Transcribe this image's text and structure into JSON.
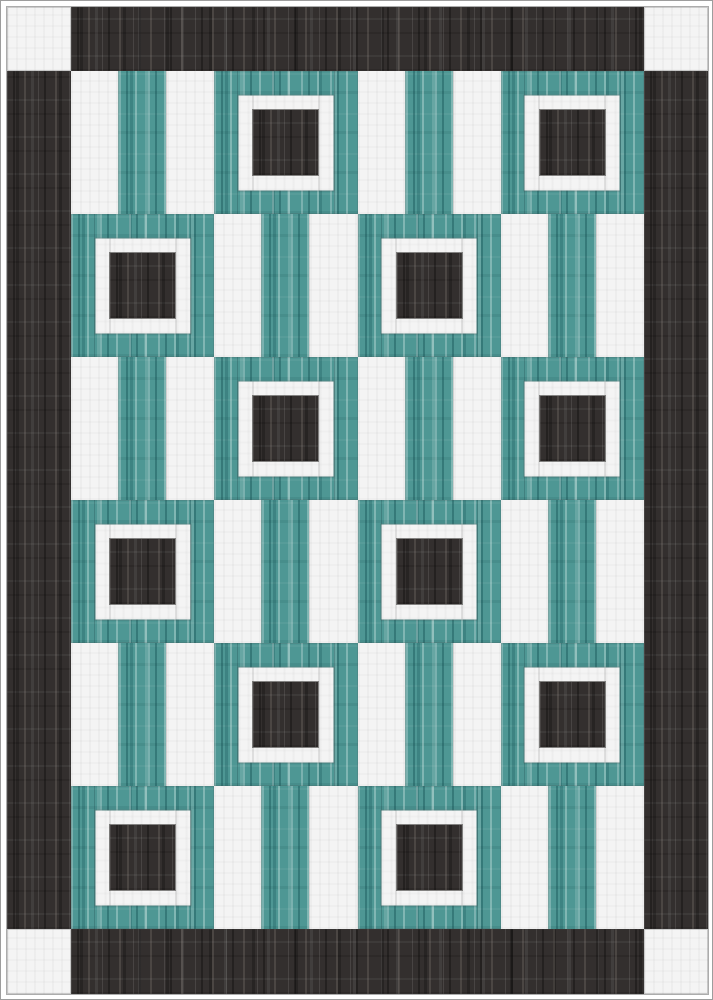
{
  "title": "Quilt pattern preview",
  "palette": {
    "page_background": "#ffffff",
    "page_edge_line": "#9d9d9d",
    "border_fabric_dark": "#332f2e",
    "fabric_teal": "#4e9794",
    "fabric_white": "#f4f4f4",
    "frame_center_dark": "#332f2e",
    "seam_line": "rgba(75,75,75,0.2)"
  },
  "quilt": {
    "border": {
      "fabric": "dark",
      "width_px": 64,
      "corner_squares": {
        "fabric": "white",
        "positions": [
          "top-left",
          "top-right",
          "bottom-left",
          "bottom-right"
        ],
        "size_px": 64
      }
    },
    "interior": {
      "columns": 4,
      "rows": 6,
      "block_width_px": 143,
      "block_height_px": 143,
      "row_patterns": [
        [
          "rails",
          "frame",
          "rails",
          "frame"
        ],
        [
          "frame",
          "rails",
          "frame",
          "rails"
        ],
        [
          "rails",
          "frame",
          "rails",
          "frame"
        ],
        [
          "frame",
          "rails",
          "frame",
          "rails"
        ],
        [
          "rails",
          "frame",
          "rails",
          "frame"
        ],
        [
          "frame",
          "rails",
          "frame",
          "rails"
        ]
      ],
      "rails_block": {
        "rails": [
          "white",
          "teal",
          "white"
        ],
        "rail_width_px": 48
      },
      "frame_block": {
        "background_fabric": "teal",
        "frame_fabric": "white",
        "frame_outer_px": 95,
        "frame_band_px": 15,
        "center_fabric": "dark",
        "center_px": 65
      }
    }
  }
}
